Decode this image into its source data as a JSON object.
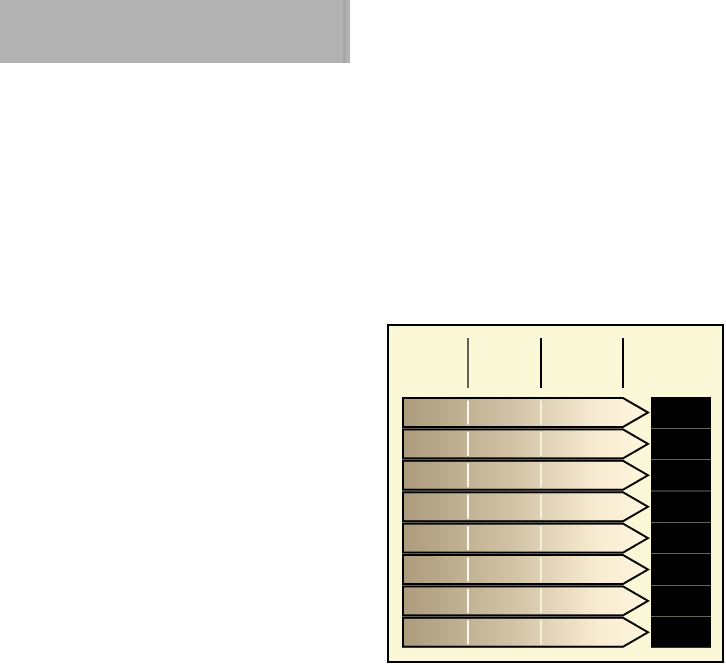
{
  "canvas": {
    "width": 726,
    "height": 665,
    "background": "#ffffff"
  },
  "header_block": {
    "x": 0,
    "y": 0,
    "width": 350,
    "height": 63,
    "color": "#b2b2b2",
    "edge_stripe": {
      "x": 343,
      "width": 3,
      "height": 63,
      "color": "#a7a7a7"
    }
  },
  "figure": {
    "x": 387,
    "y": 324,
    "width": 337,
    "height": 339,
    "background": "#fbf8d8",
    "border_color": "#000000",
    "border_width": 2,
    "ticks": {
      "color": "#000000",
      "top": 14,
      "bottom": 64,
      "items": [
        {
          "x": 81,
          "stroke_width": 1.2
        },
        {
          "x": 154,
          "stroke_width": 2
        },
        {
          "x": 236,
          "stroke_width": 2
        }
      ]
    },
    "arrows": {
      "count": 8,
      "left": 16,
      "body_right": 236,
      "tip_right": 261,
      "first_top": 74,
      "pitch": 31.4,
      "height": 29,
      "outline_color": "#000000",
      "outline_width": 2,
      "gradient_stops": [
        {
          "offset": 0,
          "color": "#ac9c7d"
        },
        {
          "offset": 0.45,
          "color": "#d2c3a6"
        },
        {
          "offset": 0.8,
          "color": "#f8ecd2"
        },
        {
          "offset": 1,
          "color": "#fff6dd"
        }
      ],
      "inner_lines": [
        {
          "x": 81,
          "color": "#fffdf0",
          "opacity": 0.95,
          "stroke_width": 2
        },
        {
          "x": 154,
          "color": "#fffdf0",
          "opacity": 0.7,
          "stroke_width": 2
        }
      ]
    },
    "label_blocks": {
      "count": 8,
      "left": 264,
      "width": 60,
      "color": "#000000"
    }
  }
}
